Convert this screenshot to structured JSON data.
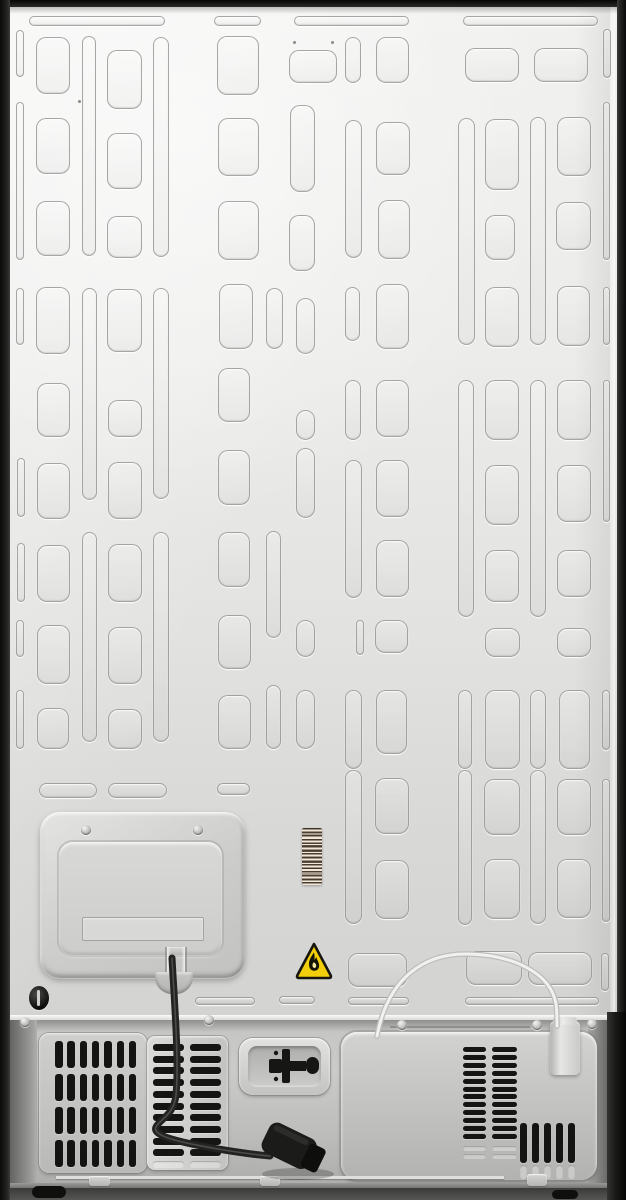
{
  "scene": {
    "subject": "refrigerator-rear-view",
    "description": "Back side of a refrigerator: embossed light-gray back sheet, evaporator access panel, barcode sticker, flammable-refrigerant warning label, bottom compressor compartment with vent grilles, power cord with plug, and water tube with fitting"
  },
  "colors": {
    "frame_black": "#1c1c1a",
    "panel_light": "#f1f1ef",
    "panel_low": "#d3d3d1",
    "compartment_gray": "#bcbcba",
    "vent_black": "#151513",
    "cord_black": "#232321",
    "warning_yellow": "#f2cf0a",
    "warning_border": "#16160f",
    "barcode_bg": "#efe7d8",
    "barcode_bar": "#423426",
    "tube_white": "#f1f1ef"
  },
  "icons": [
    {
      "name": "flame-icon",
      "meaning": "flammable refrigerant warning"
    },
    {
      "name": "valve-icon",
      "meaning": "service connector marking in recess"
    },
    {
      "name": "screw-icon",
      "meaning": "phillips screw head"
    }
  ],
  "backsheet": {
    "shapes": [
      [
        29,
        16,
        134,
        8
      ],
      [
        214,
        16,
        45,
        8
      ],
      [
        294,
        16,
        113,
        8
      ],
      [
        463,
        16,
        133,
        8
      ],
      [
        16,
        30,
        6,
        45
      ],
      [
        16,
        102,
        6,
        156
      ],
      [
        16,
        288,
        6,
        55
      ],
      [
        17,
        458,
        6,
        57
      ],
      [
        17,
        543,
        6,
        57
      ],
      [
        16,
        620,
        6,
        35
      ],
      [
        16,
        690,
        6,
        57
      ],
      [
        36,
        37,
        32,
        55
      ],
      [
        36,
        118,
        32,
        54
      ],
      [
        36,
        201,
        32,
        53
      ],
      [
        36,
        287,
        32,
        65
      ],
      [
        37,
        383,
        31,
        52
      ],
      [
        37,
        463,
        31,
        54
      ],
      [
        37,
        545,
        31,
        55
      ],
      [
        37,
        625,
        31,
        57
      ],
      [
        37,
        708,
        30,
        39
      ],
      [
        82,
        36,
        12,
        218
      ],
      [
        82,
        288,
        13,
        210
      ],
      [
        82,
        532,
        13,
        208
      ],
      [
        107,
        50,
        33,
        57
      ],
      [
        107,
        133,
        33,
        54
      ],
      [
        107,
        216,
        33,
        40
      ],
      [
        107,
        289,
        33,
        61
      ],
      [
        108,
        400,
        32,
        35
      ],
      [
        108,
        462,
        32,
        55
      ],
      [
        108,
        544,
        32,
        56
      ],
      [
        108,
        627,
        32,
        55
      ],
      [
        108,
        709,
        32,
        38
      ],
      [
        153,
        37,
        14,
        218
      ],
      [
        153,
        288,
        14,
        209
      ],
      [
        153,
        532,
        14,
        208
      ],
      [
        39,
        783,
        56,
        13
      ],
      [
        108,
        783,
        57,
        13
      ],
      [
        217,
        36,
        40,
        57
      ],
      [
        218,
        118,
        39,
        56
      ],
      [
        218,
        201,
        39,
        57
      ],
      [
        219,
        284,
        32,
        63
      ],
      [
        218,
        368,
        30,
        52
      ],
      [
        218,
        450,
        30,
        53
      ],
      [
        218,
        532,
        30,
        53
      ],
      [
        218,
        615,
        31,
        52
      ],
      [
        218,
        695,
        31,
        52
      ],
      [
        217,
        783,
        31,
        10
      ],
      [
        289,
        50,
        46,
        31
      ],
      [
        290,
        105,
        23,
        85
      ],
      [
        289,
        215,
        24,
        54
      ],
      [
        296,
        298,
        17,
        54
      ],
      [
        296,
        410,
        17,
        28
      ],
      [
        296,
        448,
        17,
        68
      ],
      [
        296,
        620,
        17,
        35
      ],
      [
        296,
        690,
        17,
        57
      ],
      [
        266,
        288,
        15,
        59
      ],
      [
        266,
        531,
        13,
        105
      ],
      [
        266,
        685,
        13,
        62
      ],
      [
        345,
        37,
        14,
        44
      ],
      [
        345,
        120,
        15,
        136
      ],
      [
        345,
        287,
        13,
        52
      ],
      [
        345,
        380,
        14,
        58
      ],
      [
        345,
        460,
        15,
        136
      ],
      [
        356,
        620,
        6,
        33
      ],
      [
        345,
        690,
        15,
        77
      ],
      [
        345,
        770,
        15,
        152
      ],
      [
        376,
        37,
        31,
        44
      ],
      [
        376,
        122,
        32,
        51
      ],
      [
        378,
        200,
        30,
        57
      ],
      [
        376,
        284,
        31,
        63
      ],
      [
        376,
        380,
        31,
        55
      ],
      [
        376,
        460,
        31,
        55
      ],
      [
        376,
        540,
        31,
        55
      ],
      [
        375,
        620,
        31,
        31
      ],
      [
        376,
        690,
        29,
        62
      ],
      [
        375,
        778,
        32,
        54
      ],
      [
        375,
        860,
        32,
        57
      ],
      [
        465,
        48,
        52,
        32
      ],
      [
        534,
        48,
        52,
        32
      ],
      [
        458,
        118,
        15,
        225
      ],
      [
        458,
        380,
        14,
        235
      ],
      [
        458,
        690,
        12,
        77
      ],
      [
        458,
        770,
        12,
        153
      ],
      [
        485,
        119,
        32,
        69
      ],
      [
        485,
        215,
        28,
        43
      ],
      [
        485,
        287,
        32,
        58
      ],
      [
        485,
        380,
        32,
        58
      ],
      [
        485,
        465,
        32,
        58
      ],
      [
        485,
        550,
        32,
        50
      ],
      [
        485,
        628,
        33,
        27
      ],
      [
        485,
        690,
        33,
        77
      ],
      [
        484,
        779,
        34,
        54
      ],
      [
        484,
        859,
        34,
        58
      ],
      [
        530,
        117,
        14,
        226
      ],
      [
        530,
        380,
        14,
        235
      ],
      [
        530,
        690,
        14,
        77
      ],
      [
        530,
        770,
        14,
        152
      ],
      [
        557,
        117,
        32,
        57
      ],
      [
        556,
        202,
        33,
        46
      ],
      [
        557,
        286,
        31,
        58
      ],
      [
        557,
        380,
        32,
        58
      ],
      [
        557,
        465,
        32,
        55
      ],
      [
        557,
        550,
        32,
        45
      ],
      [
        557,
        628,
        32,
        27
      ],
      [
        559,
        690,
        29,
        77
      ],
      [
        557,
        779,
        32,
        54
      ],
      [
        557,
        859,
        32,
        57
      ],
      [
        603,
        29,
        6,
        47
      ],
      [
        603,
        102,
        5,
        156
      ],
      [
        603,
        287,
        5,
        56
      ],
      [
        603,
        380,
        5,
        140
      ],
      [
        602,
        690,
        6,
        58
      ],
      [
        602,
        779,
        6,
        141
      ],
      [
        348,
        953,
        57,
        32
      ],
      [
        466,
        951,
        54,
        32
      ],
      [
        528,
        952,
        62,
        31
      ],
      [
        601,
        953,
        6,
        36
      ],
      [
        195,
        997,
        58,
        6
      ],
      [
        279,
        996,
        34,
        6
      ],
      [
        348,
        997,
        59,
        6
      ],
      [
        465,
        997,
        132,
        6
      ]
    ],
    "dots": [
      [
        78,
        100
      ],
      [
        293,
        41
      ],
      [
        331,
        41
      ]
    ]
  },
  "vents": {
    "left_grille": {
      "rows_y": [
        1041,
        1074,
        1107,
        1140
      ],
      "slat": {
        "x0": 55,
        "step": 12.3,
        "count": 7,
        "w": 7.5,
        "h": 27
      }
    },
    "middle_vent": {
      "cols": [
        {
          "x": 153,
          "w": 31
        },
        {
          "x": 190,
          "w": 31
        }
      ],
      "rows": {
        "y0": 1044,
        "step": 11.7,
        "count": 10,
        "h": 7
      },
      "ghost_rows_y": [
        1161
      ]
    },
    "right_vent": {
      "cols": [
        {
          "x": 463,
          "w": 23
        },
        {
          "x": 492,
          "w": 25
        }
      ],
      "rows": {
        "y0": 1047,
        "step": 7.9,
        "count": 12,
        "h": 5
      },
      "ghost_rows_y": [
        1146,
        1154
      ],
      "vertical_slats": {
        "x0": 520,
        "step": 12,
        "count": 5,
        "w": 7,
        "h": 40,
        "y": 1123
      }
    }
  },
  "screws": [
    [
      86,
      830
    ],
    [
      198,
      830
    ],
    [
      25,
      1022
    ],
    [
      209,
      1020
    ],
    [
      402,
      1025
    ],
    [
      537,
      1025
    ],
    [
      592,
      1024
    ]
  ],
  "tabs": [
    [
      89,
      1176,
      21,
      10
    ],
    [
      260,
      1176,
      20,
      10
    ],
    [
      527,
      1174,
      20,
      12
    ]
  ],
  "feet": [
    [
      32,
      1186,
      34,
      12
    ],
    [
      552,
      1190,
      26,
      9
    ]
  ],
  "paths": {
    "power_cord": "M172,958 C175,1012 179,1062 176,1095 C174,1115 160,1119 156,1127 C152,1136 178,1142 218,1149 C242,1153 258,1155 270,1156",
    "water_tube": "M377,1036 C388,978 424,953 468,954 C515,955 551,974 556,1004 C557,1012 557,1018 557,1026",
    "flame_outer": "M20 12.5 C16.5 17.5 14.8 20.5 15 24.8 C15.2 28.6 17.3 30.8 20.2 30.8 C23.4 30.8 25.2 28.4 25.1 25.4 C25 21.8 22.8 19.7 22.2 16.9 C21.7 18.4 21 19.3 20.4 19.8 C20.8 17.3 20.6 14.8 20 12.5 Z",
    "flame_core": "M19.6 22.2 C18.4 23.8 18.1 25.4 18.8 26.9 C19.4 28.1 21 28.3 21.8 27.3 C22.6 26.2 22.3 24.7 21.2 23.3 C20.7 22.7 20.1 22.4 19.6 22.2 Z",
    "warning_triangle": "M20 4 L36.5 35 Q38 38 34.5 38 L5.5 38 Q2 38 3.5 35 Z"
  }
}
